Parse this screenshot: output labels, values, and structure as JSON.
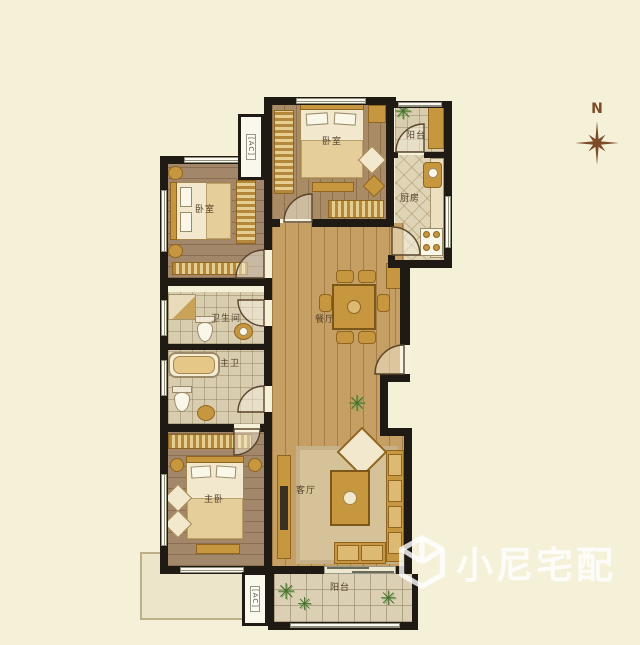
{
  "compass": {
    "label": "N"
  },
  "watermark": {
    "text": "小尼宅配",
    "icon": "cube-logo"
  },
  "icons": {
    "plant": "✳"
  },
  "palette": {
    "background": "#f5f1d9",
    "wall": "#201a14",
    "hall_wood": "#c59f63",
    "bedroom_wood": "#a98c66",
    "tile": "#d9cdb0",
    "furniture_gold": "#c6973f",
    "compass_brown": "#7d4b28"
  },
  "rooms": {
    "bedroom_top": {
      "label": "卧室"
    },
    "balcony_top": {
      "label": "阳台"
    },
    "kitchen": {
      "label": "厨房"
    },
    "bedroom_left": {
      "label": "卧室"
    },
    "bathroom": {
      "label": "卫生间"
    },
    "master_bathroom": {
      "label": "主卫"
    },
    "dining_room": {
      "label": "餐厅"
    },
    "living_room": {
      "label": "客厅"
    },
    "master_bedroom": {
      "label": "主卧"
    },
    "balcony_bottom": {
      "label": "阳台"
    }
  },
  "ac_units": [
    {
      "label": "[AC]"
    },
    {
      "label": "[AC]"
    }
  ]
}
